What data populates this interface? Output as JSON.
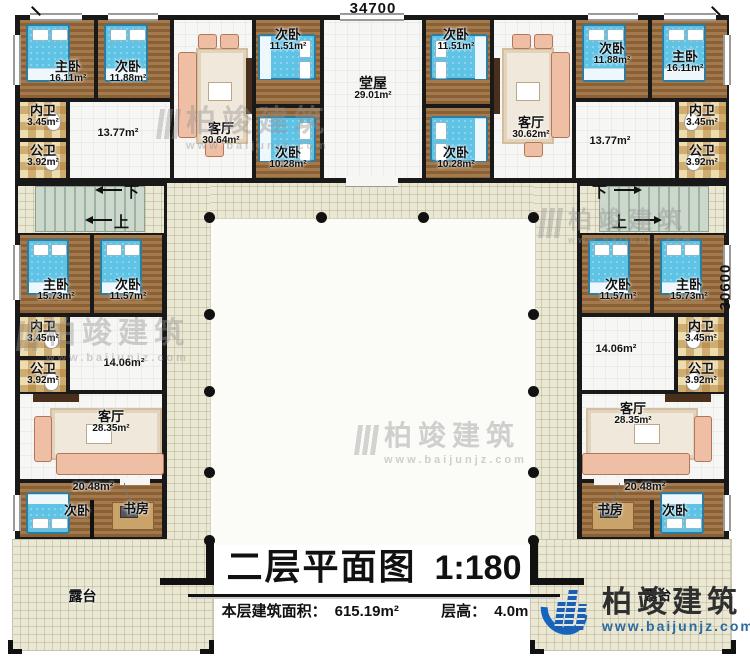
{
  "meta": {
    "plan_title": "二层平面图",
    "plan_scale": "1:180",
    "area_label": "本层建筑面积：",
    "area_value": "615.19m²",
    "height_label": "层高：",
    "height_value": "4.0m",
    "dim_top": "34700",
    "dim_right": "30600"
  },
  "logo": {
    "name": "柏竣建筑",
    "url": "www.baijunjz.com"
  },
  "watermark": {
    "name": "柏竣建筑",
    "url": "www.baijunjz.com"
  },
  "stairs": {
    "down_label": "下",
    "up_label": "上"
  },
  "rooms": {
    "tl_master": {
      "label": "主卧",
      "area": "16.11m²"
    },
    "tl_bed2": {
      "label": "次卧",
      "area": "11.88m²"
    },
    "tl_living": {
      "label": "客厅",
      "area": "30.64m²"
    },
    "tl_bath_private": {
      "label": "内卫",
      "area": "3.45m²"
    },
    "tl_bath_public": {
      "label": "公卫",
      "area": "3.92m²"
    },
    "tl_hall": {
      "area": "13.77m²"
    },
    "ml_bed_upper": {
      "label": "次卧",
      "area": "11.51m²"
    },
    "ml_bed_lower": {
      "label": "次卧",
      "area": "10.28m²"
    },
    "hall_main": {
      "label": "堂屋",
      "area": "29.01m²"
    },
    "mr_bed_upper": {
      "label": "次卧",
      "area": "11.51m²"
    },
    "mr_bed_lower": {
      "label": "次卧",
      "area": "10.28m²"
    },
    "tr_living": {
      "label": "客厅",
      "area": "30.62m²"
    },
    "tr_bed2": {
      "label": "次卧",
      "area": "11.88m²"
    },
    "tr_master": {
      "label": "主卧",
      "area": "16.11m²"
    },
    "tr_bath_private": {
      "label": "内卫",
      "area": "3.45m²"
    },
    "tr_bath_public": {
      "label": "公卫",
      "area": "3.92m²"
    },
    "tr_hall": {
      "area": "13.77m²"
    },
    "lw_master": {
      "label": "主卧",
      "area": "15.73m²"
    },
    "lw_bed2": {
      "label": "次卧",
      "area": "11.57m²"
    },
    "lw_bath_private": {
      "label": "内卫",
      "area": "3.45m²"
    },
    "lw_bath_public": {
      "label": "公卫",
      "area": "3.92m²"
    },
    "lw_hall": {
      "area": "14.06m²"
    },
    "lw_living": {
      "label": "客厅",
      "area": "28.35m²"
    },
    "lw_suite": {
      "area": "20.48m²"
    },
    "lw_bed3": {
      "label": "次卧"
    },
    "lw_study": {
      "label": "书房"
    },
    "lw_terrace": {
      "label": "露台"
    },
    "rw_bed2": {
      "label": "次卧",
      "area": "11.57m²"
    },
    "rw_master": {
      "label": "主卧",
      "area": "15.73m²"
    },
    "rw_bath_private": {
      "label": "内卫",
      "area": "3.45m²"
    },
    "rw_bath_public": {
      "label": "公卫",
      "area": "3.92m²"
    },
    "rw_hall": {
      "area": "14.06m²"
    },
    "rw_living": {
      "label": "客厅",
      "area": "28.35m²"
    },
    "rw_suite": {
      "area": "20.48m²"
    },
    "rw_study": {
      "label": "书房"
    },
    "rw_bed3": {
      "label": "次卧"
    },
    "rw_terrace": {
      "label": "露台"
    }
  }
}
